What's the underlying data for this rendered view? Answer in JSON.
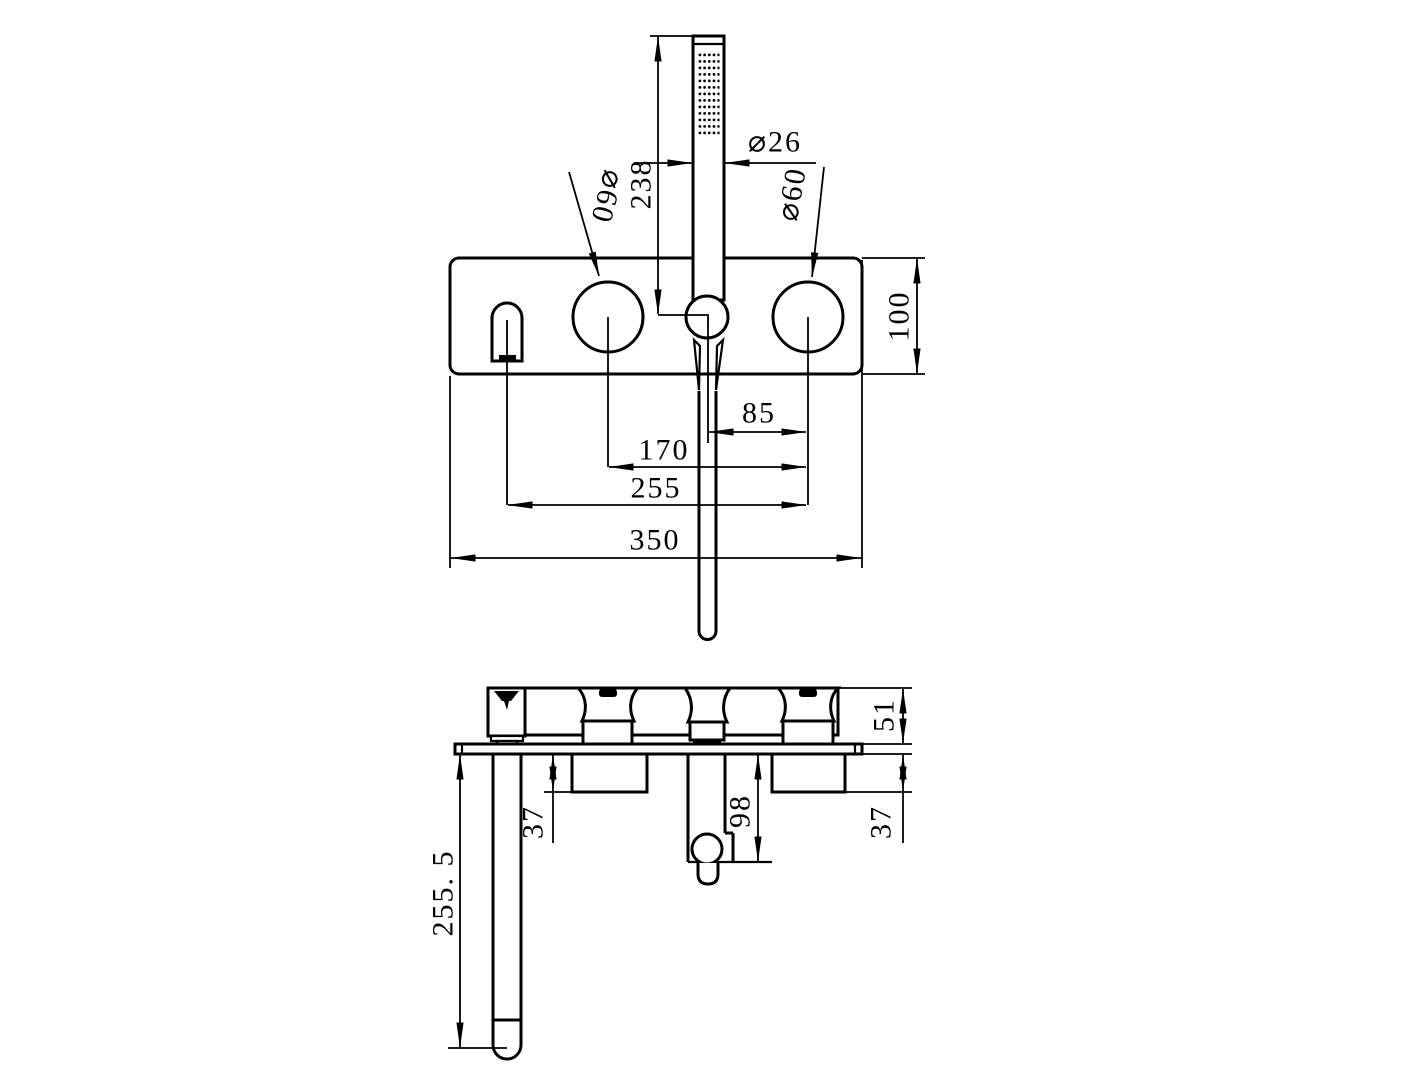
{
  "drawing": {
    "type": "bath-shower-mixer-installation-drawing",
    "colors": {
      "line": "#000000",
      "background": "#ffffff"
    },
    "dims": {
      "wand_length": "238",
      "wand_diameter": "⌀26",
      "left_handle_diameter": "⌀60",
      "right_handle_diameter": "⌀60",
      "plate_height": "100",
      "holder_to_handle": "85",
      "handle_spacing": "170",
      "spout_to_handle": "255",
      "plate_width": "350",
      "trim_height": "51",
      "left_valve_depth": "37",
      "elbow_depth": "98",
      "right_valve_depth": "37",
      "spout_reach": "255. 5"
    }
  }
}
